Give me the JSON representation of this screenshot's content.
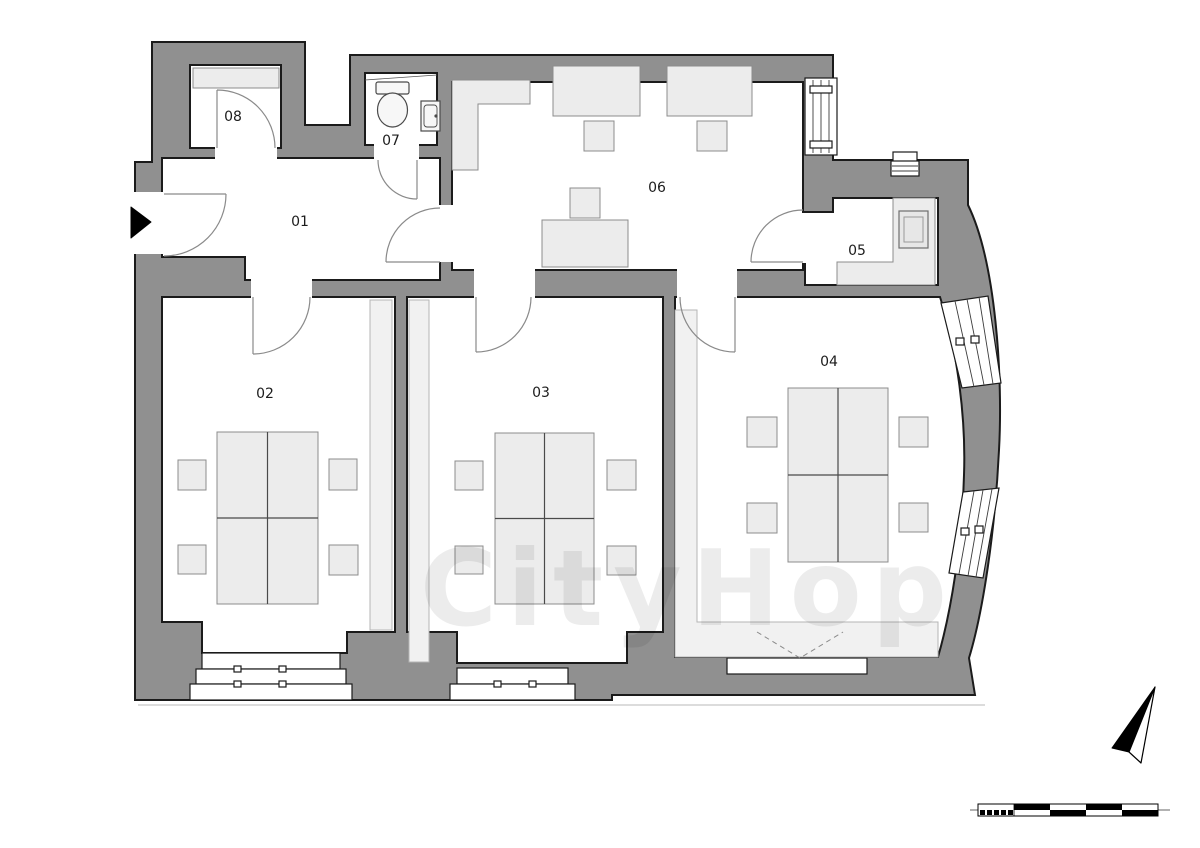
{
  "rooms": {
    "r01": {
      "label": "01"
    },
    "r02": {
      "label": "02"
    },
    "r03": {
      "label": "03"
    },
    "r04": {
      "label": "04"
    },
    "r05": {
      "label": "05"
    },
    "r06": {
      "label": "06"
    },
    "r07": {
      "label": "07"
    },
    "r08": {
      "label": "08"
    }
  },
  "watermark": {
    "text": "CityHop"
  },
  "icons": {
    "entrance": "entrance-arrow",
    "north": "north-arrow",
    "scale": "scale-bar"
  },
  "colors": {
    "wall_fill": "#909090",
    "wall_outline": "#1b1b1b",
    "room_fill": "#ffffff",
    "furniture_fill": "#ececec",
    "furniture_stroke": "#8c8c8c",
    "accent_floor": "#f1f1f1",
    "door_stroke": "#8a8a8a",
    "label": "#1c1c1c",
    "marker_black": "#000000",
    "ground_line": "#b8b8b8",
    "watermark_color": "#000000"
  }
}
